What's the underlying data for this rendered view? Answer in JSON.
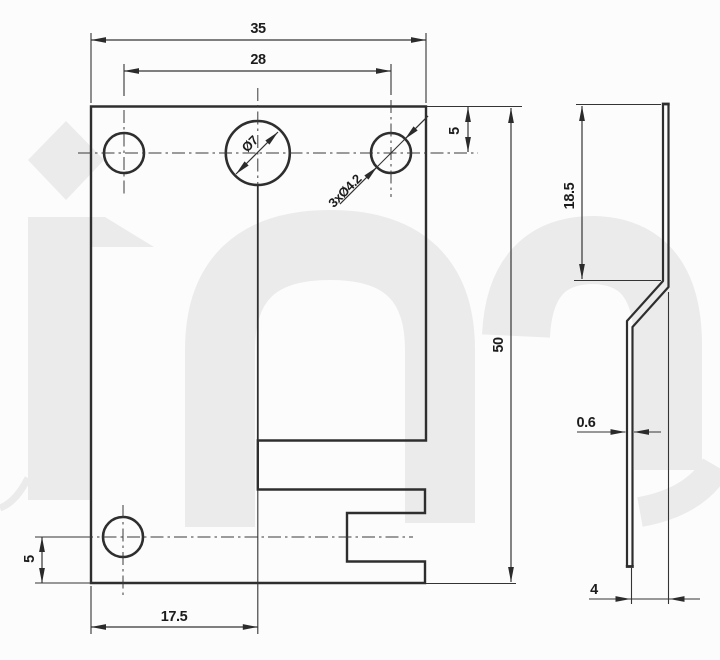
{
  "drawing": {
    "dims": {
      "width_top": "35",
      "hole_pitch": "28",
      "top_hole_offset": "5",
      "overall_height": "50",
      "bottom_hole_x": "17.5",
      "bottom_hole_y": "5",
      "center_hole_dia": "Ø7",
      "small_holes_note": "3xØ4.2",
      "side_top_length": "18.5",
      "sheet_thickness": "0.6",
      "bend_offset": "4"
    }
  },
  "colors": {
    "line": "#2e2e2e",
    "text": "#1c1c1c",
    "watermark": "#ebebeb",
    "background": "#fcfcfc"
  }
}
